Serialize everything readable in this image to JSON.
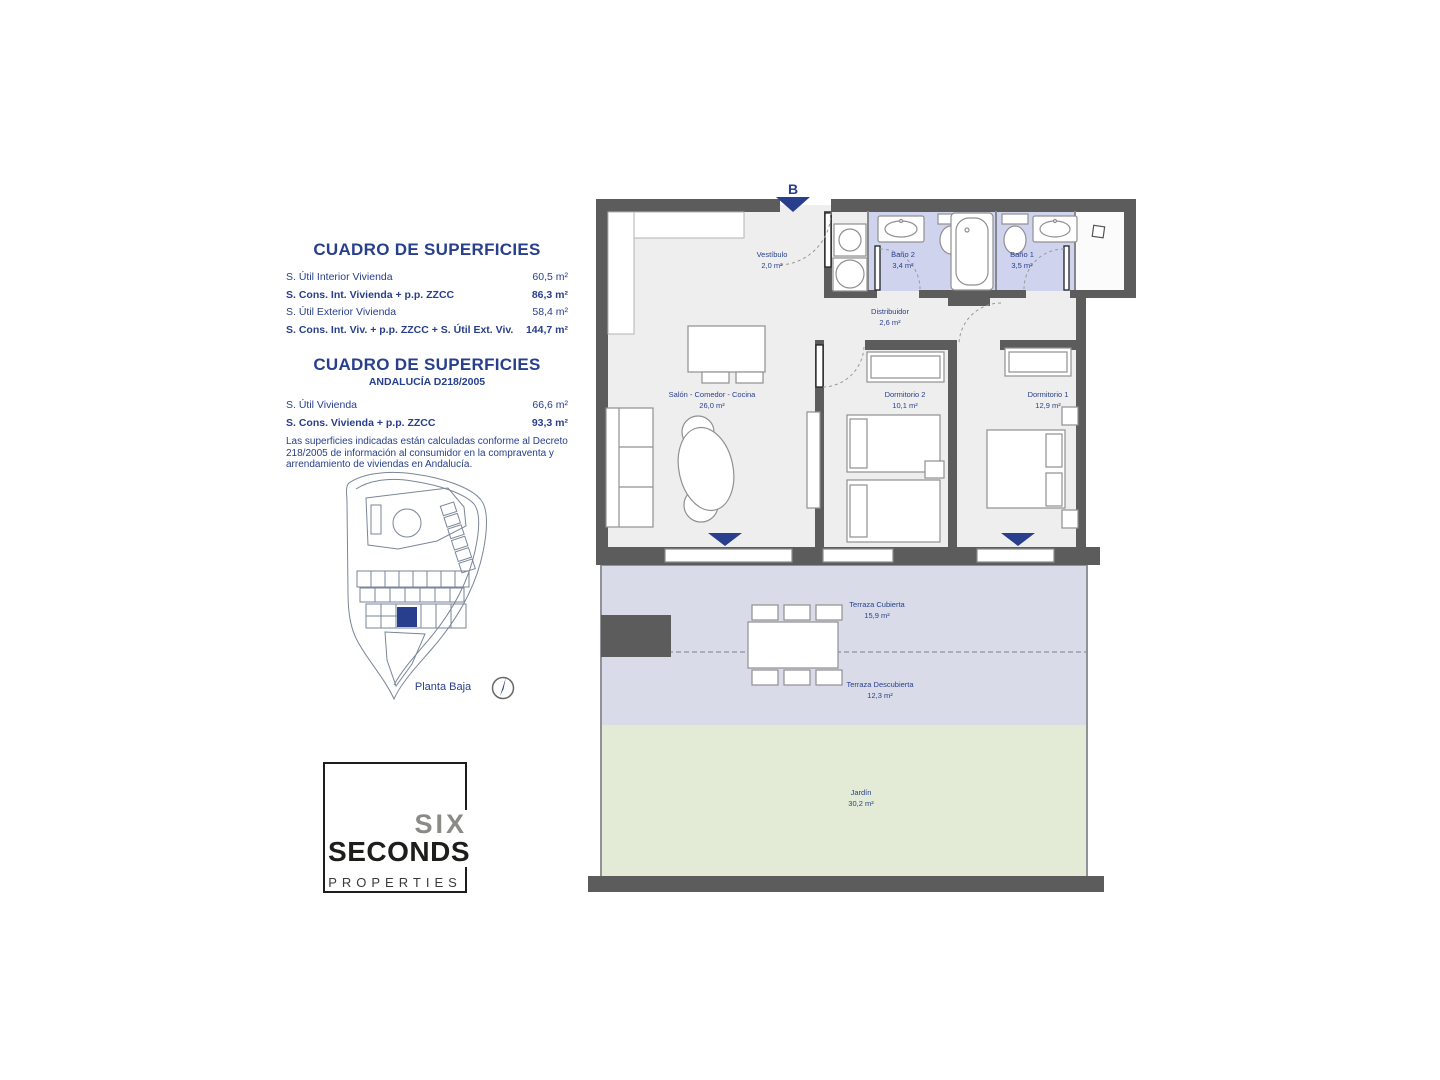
{
  "surfaces_table_1": {
    "title": "CUADRO DE SUPERFICIES",
    "rows": [
      {
        "label": "S. Útil Interior Vivienda",
        "value": "60,5 m²",
        "bold": false
      },
      {
        "label": "S. Cons. Int. Vivienda + p.p. ZZCC",
        "value": "86,3 m²",
        "bold": true
      },
      {
        "label": "S. Útil Exterior Vivienda",
        "value": "58,4 m²",
        "bold": false
      },
      {
        "label": "S. Cons. Int. Viv. + p.p. ZZCC + S. Útil Ext. Viv.",
        "value": "144,7 m²",
        "bold": true
      }
    ]
  },
  "surfaces_table_2": {
    "title": "CUADRO DE SUPERFICIES",
    "subtitle": "ANDALUCÍA D218/2005",
    "rows": [
      {
        "label": "S. Útil Vivienda",
        "value": "66,6 m²",
        "bold": false
      },
      {
        "label": "S. Cons. Vivienda + p.p. ZZCC",
        "value": "93,3 m²",
        "bold": true
      }
    ],
    "note": "Las superficies indicadas están calculadas conforme al Decreto 218/2005 de información al consumidor en la compraventa y arrendamiento de viviendas en Andalucía."
  },
  "site_plan": {
    "floor_label": "Planta Baja"
  },
  "logo": {
    "line1": "SIX",
    "line2": "SECONDS",
    "line3": "PROPERTIES"
  },
  "floor_plan": {
    "entrance_label": "B",
    "rooms": [
      {
        "name": "Vestíbulo",
        "area": "2,0 m²"
      },
      {
        "name": "Baño 2",
        "area": "3,4 m²"
      },
      {
        "name": "Baño 1",
        "area": "3,5 m²"
      },
      {
        "name": "Distribuidor",
        "area": "2,6 m²"
      },
      {
        "name": "Salón - Comedor - Cocina",
        "area": "26,0 m²"
      },
      {
        "name": "Dormitorio 2",
        "area": "10,1 m²"
      },
      {
        "name": "Dormitorio 1",
        "area": "12,9 m²"
      },
      {
        "name": "Terraza Cubierta",
        "area": "15,9 m²"
      },
      {
        "name": "Terraza Descubierta",
        "area": "12,3 m²"
      },
      {
        "name": "Jardín",
        "area": "30,2 m²"
      }
    ]
  },
  "colors": {
    "accent_navy": "#273f8c",
    "wall_gray": "#5c5c5c",
    "bathroom_fill": "#cfd3ee",
    "terrace_fill": "#d9dce8",
    "garden_fill": "#e3ebd6"
  }
}
